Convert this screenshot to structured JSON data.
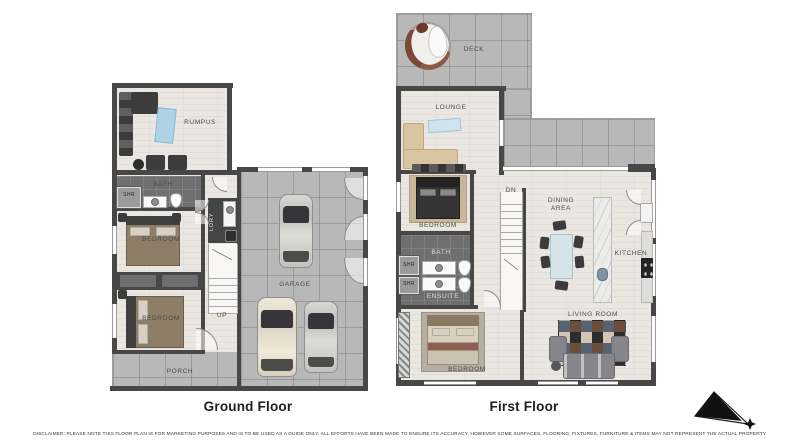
{
  "disclaimer": "DISCLAIMER: PLEASE NOTE THIS FLOOR PLAN IS FOR MARKETING PURPOSES AND IS TO BE USED AS A GUIDE ONLY. ALL EFFORTS HAVE BEEN MADE TO ENSURE ITS ACCURACY, HOWEVER SOME SURFACES, FLOORING, FIXTURES, FURNITURE & ITEMS MAY NOT REPRESENT THE ACTUAL PROPERTY.",
  "ground_floor": {
    "title": "Ground Floor",
    "labels": {
      "rumpus": "RUMPUS",
      "bath": "BATH",
      "shr": "SHR",
      "ldry": "LDRY",
      "bedroom_front": "BEDROOM",
      "bedroom_rear": "BEDROOM",
      "up": "UP",
      "garage": "GARAGE",
      "porch": "PORCH"
    }
  },
  "first_floor": {
    "title": "First Floor",
    "labels": {
      "deck": "DECK",
      "lounge": "LOUNGE",
      "bedroom_left": "BEDROOM",
      "dn": "DN",
      "dining_area": "DINING AREA",
      "kitchen": "KITCHEN",
      "bath": "BATH",
      "shr_upper": "SHR",
      "shr_lower": "SHR",
      "ensuite": "ENSUITE",
      "living_room": "LIVING ROOM",
      "bedroom_lower": "BEDROOM"
    }
  },
  "colors": {
    "wall": "#474747",
    "tile_floor": "#b8b8b8",
    "wood_floor": "#eae7e2",
    "wet_area_floor": "#6f6f6f",
    "label_text": "#4a4a4a",
    "title_text": "#1e1e1e"
  }
}
